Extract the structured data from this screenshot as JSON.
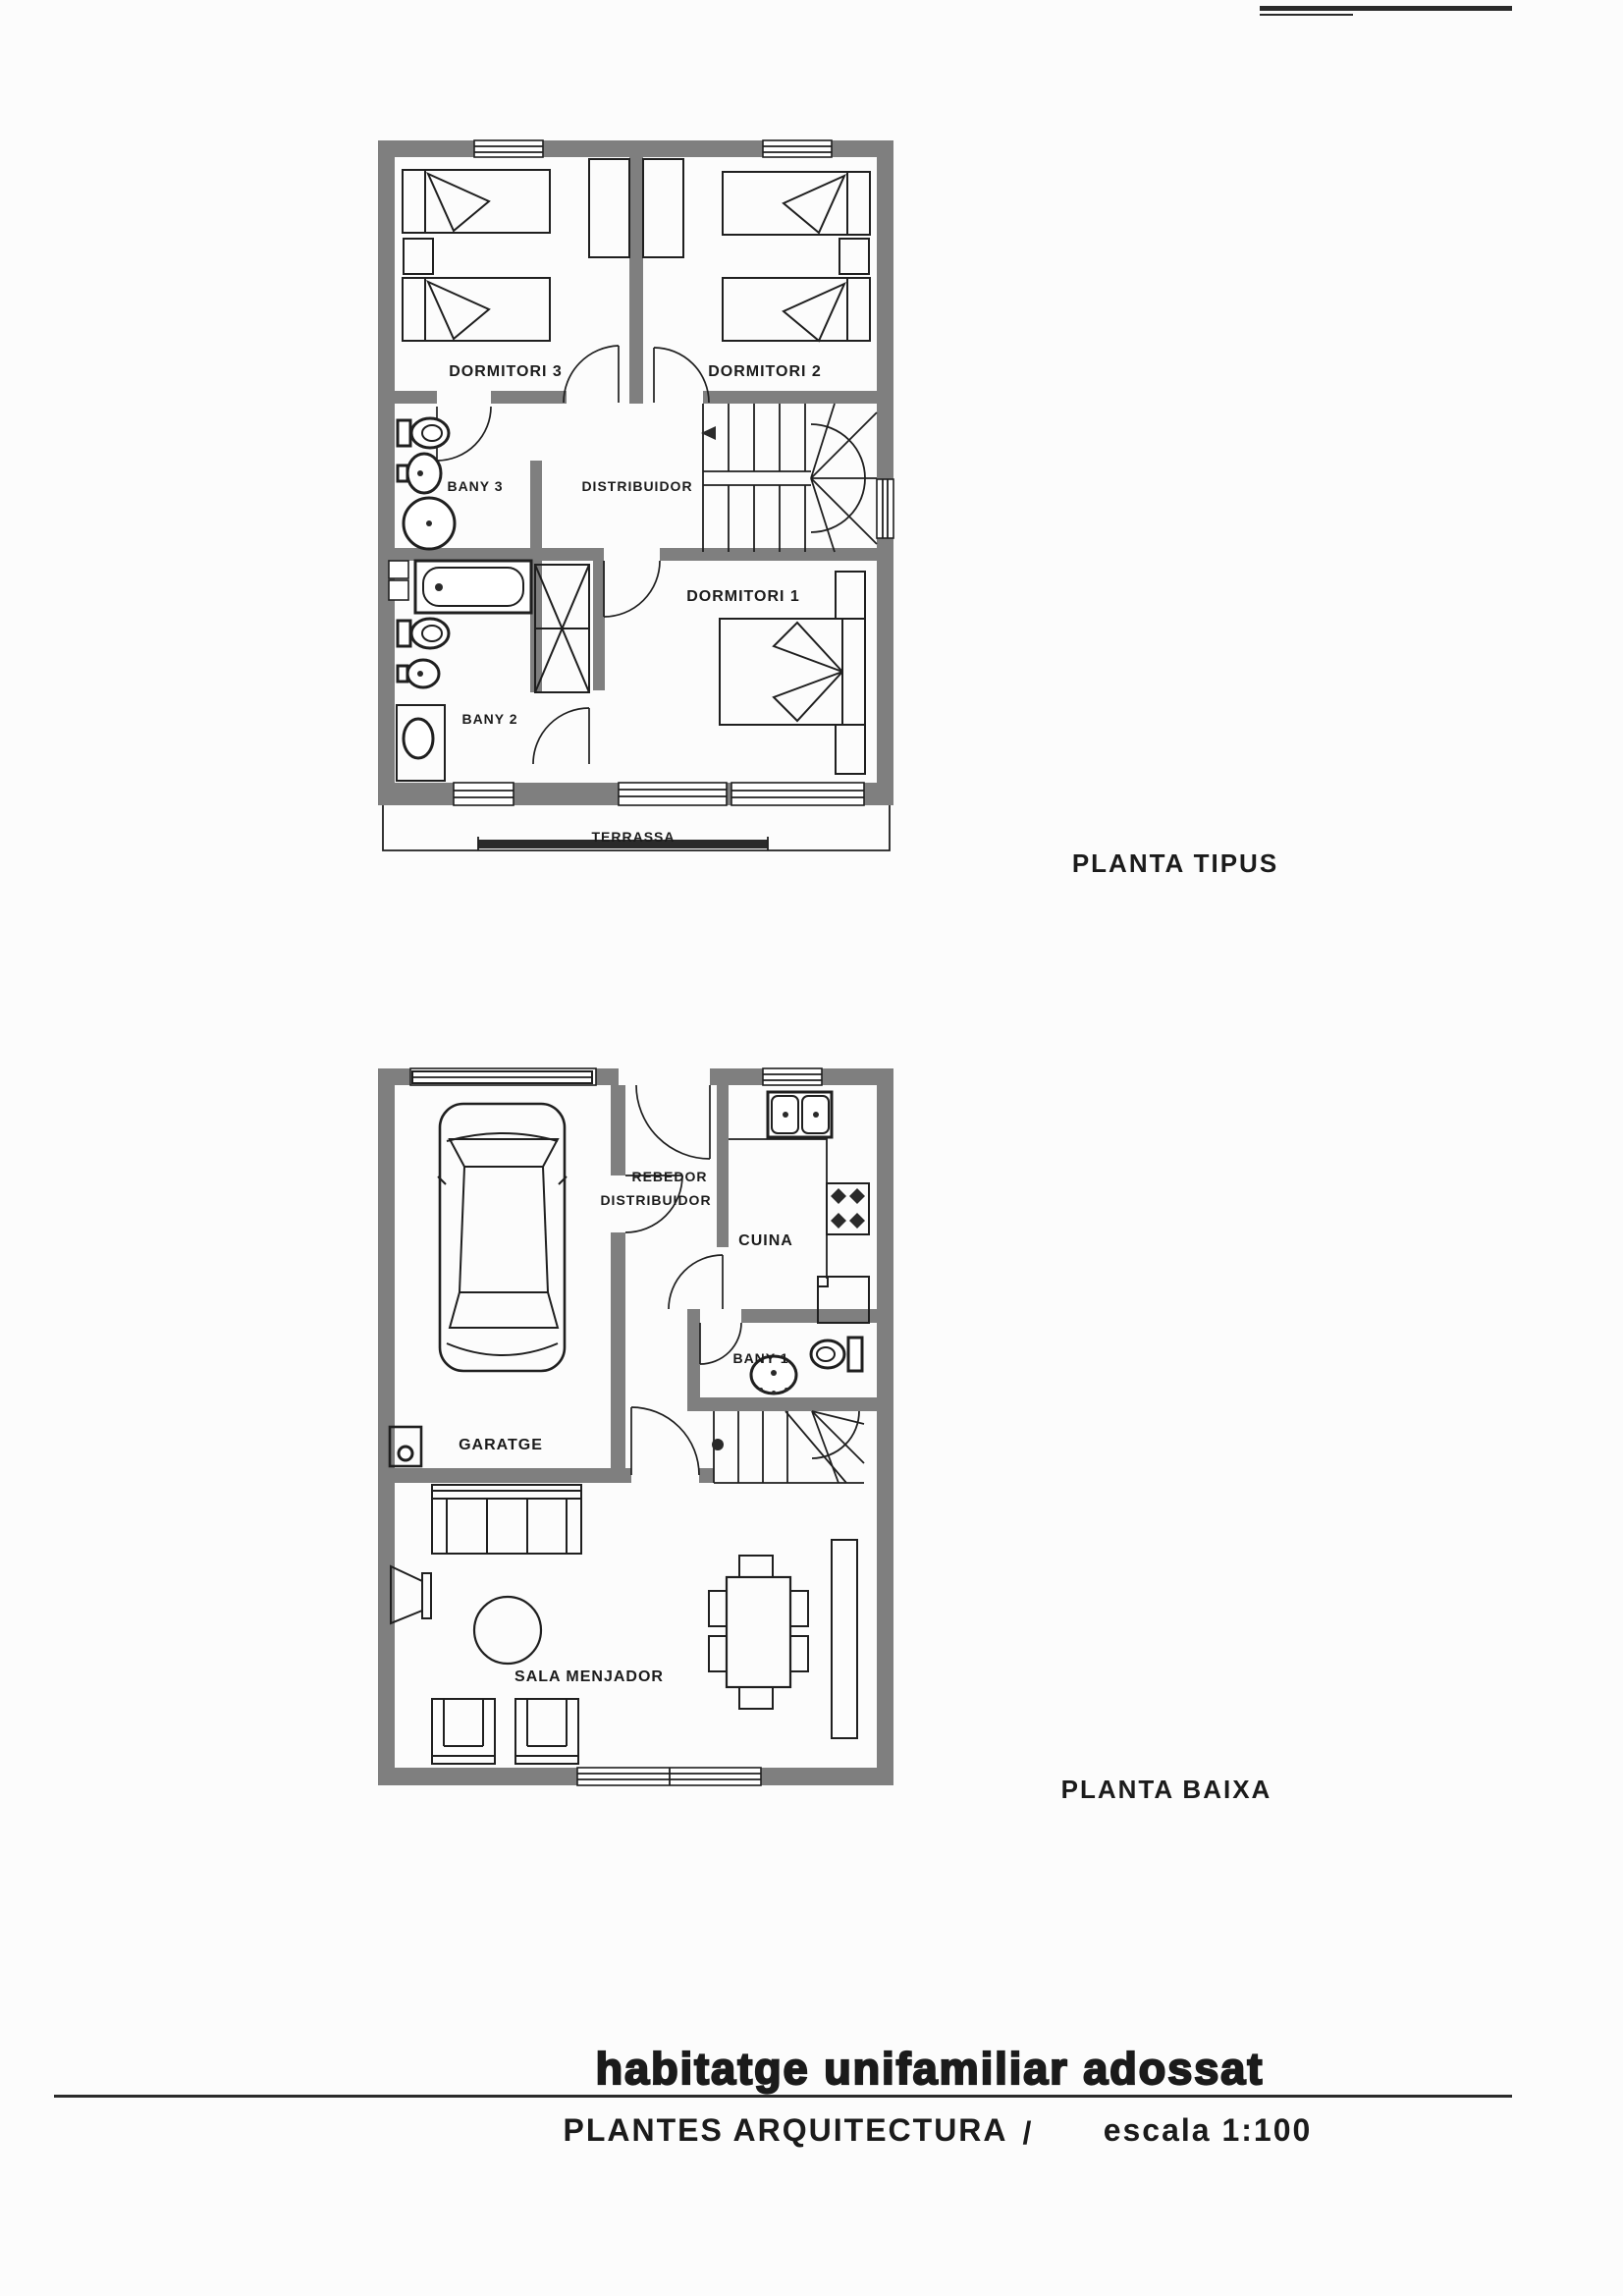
{
  "sheet": {
    "footer": {
      "title": "habitatge unifamiliar adossat",
      "subtitle_left": "PLANTES ARQUITECTURA",
      "subtitle_divider": "/",
      "subtitle_right": "escala 1:100"
    },
    "colors": {
      "wall_gray": "#7f7f7f",
      "ink": "#1f1f1f",
      "paper": "#fcfcfc"
    }
  },
  "upper_plan": {
    "caption": "PLANTA TIPUS",
    "rooms": {
      "dormitori3": "DORMITORI 3",
      "dormitori2": "DORMITORI 2",
      "bany3": "BANY 3",
      "distribuidor": "DISTRIBUIDOR",
      "dormitori1": "DORMITORI 1",
      "bany2": "BANY 2",
      "terrassa": "TERRASSA"
    }
  },
  "lower_plan": {
    "caption": "PLANTA BAIXA",
    "rooms": {
      "rebedor": "REBEDOR",
      "distribuidor": "DISTRIBUIDOR",
      "cuina": "CUINA",
      "bany1": "BANY 1",
      "garatge": "GARATGE",
      "sala_menjador": "SALA MENJADOR"
    }
  }
}
